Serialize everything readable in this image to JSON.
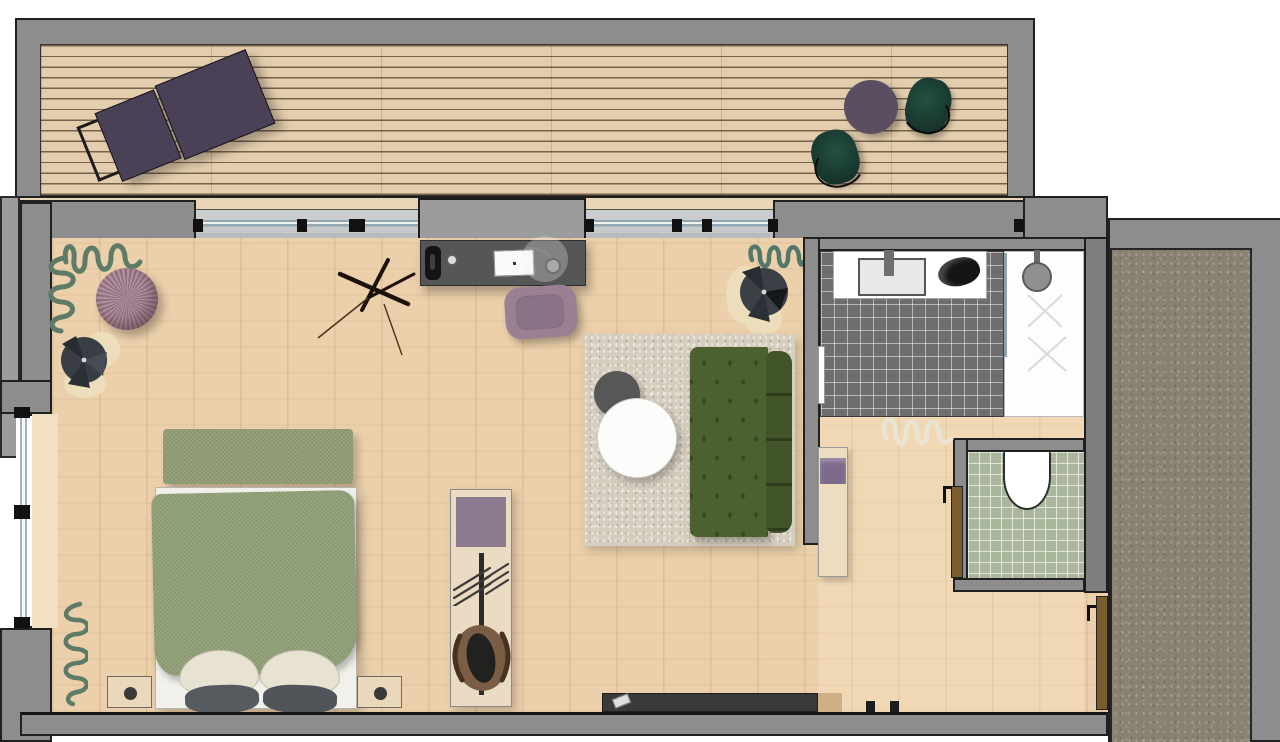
{
  "title": "Studio apartment floor plan",
  "canvas": {
    "width": 1280,
    "height": 742
  },
  "palette": {
    "wall_gray": "#8d8d8d",
    "outline_black": "#202020",
    "room_wood": "#ebd0ab",
    "deck_wood": "#e3cdad",
    "corridor_carpet": "#8a8172",
    "rug_beige": "#d5cdbd",
    "sofa_green": "#4c6030",
    "bed_green": "#90a075",
    "tile_dark": "#6e6e6e",
    "tile_green": "#aab79d",
    "accent_mauve": "#8d7b8f",
    "lounger_purple": "#4a4156",
    "deck_chair_green": "#1d3b31",
    "door_brown": "#7b5c2e"
  },
  "rooms": {
    "terrace": {
      "label": "Terrace deck"
    },
    "living": {
      "label": "Bedroom and living area"
    },
    "bathroom": {
      "label": "Bathroom"
    },
    "wc": {
      "label": "WC"
    },
    "hallway": {
      "label": "Hallway"
    },
    "corridor": {
      "label": "Corridor with carpet"
    }
  },
  "items": {
    "sun_lounger": {
      "label": "Sun lounger",
      "color": "#4a4156"
    },
    "bistro_table": {
      "label": "Round bistro table",
      "color": "#5c4e62"
    },
    "deck_chair_a": {
      "label": "Deck chair",
      "color": "#1d3b31"
    },
    "deck_chair_b": {
      "label": "Deck chair",
      "color": "#1d3b31"
    },
    "bed": {
      "label": "Double bed with green duvet"
    },
    "foot_bench": {
      "label": "Bed-end bench"
    },
    "nightstand_left": {
      "label": "Nightstand"
    },
    "nightstand_right": {
      "label": "Nightstand"
    },
    "wardrobe": {
      "label": "Valet wardrobe panel"
    },
    "travel_bag": {
      "label": "Travel bag"
    },
    "desk": {
      "label": "Desk"
    },
    "laptop": {
      "label": "Laptop"
    },
    "desk_chair": {
      "label": "Desk chair",
      "color": "#9a8093"
    },
    "tripod_lamp": {
      "label": "Tripod floor lamp"
    },
    "armchair_left": {
      "label": "Swivel armchair"
    },
    "armchair_right": {
      "label": "Swivel armchair"
    },
    "pouf": {
      "label": "Knitted pouf",
      "color": "#a4808f"
    },
    "rug": {
      "label": "Shag rug"
    },
    "coffee_table_dark": {
      "label": "Round coffee table, dark"
    },
    "coffee_table_white": {
      "label": "Round coffee table, white"
    },
    "sofa": {
      "label": "Tufted sofa",
      "color": "#4c6030"
    },
    "sideboard": {
      "label": "TV sideboard"
    },
    "remote": {
      "label": "Remote control"
    },
    "vanity": {
      "label": "Vanity with sink"
    },
    "shower": {
      "label": "Walk-in shower"
    },
    "toiletry_bag": {
      "label": "Toiletry bag"
    },
    "bath_door": {
      "label": "Bathroom door, open"
    },
    "toilet": {
      "label": "Toilet"
    },
    "wc_door": {
      "label": "WC door"
    },
    "hall_bench": {
      "label": "Bench with towel"
    },
    "entry_door": {
      "label": "Entry door"
    },
    "plant_top_left": {
      "label": "Plant"
    },
    "plant_top_right": {
      "label": "Plant"
    },
    "plant_bottom_left": {
      "label": "Plant"
    },
    "plant_hallway": {
      "label": "Plant"
    }
  }
}
